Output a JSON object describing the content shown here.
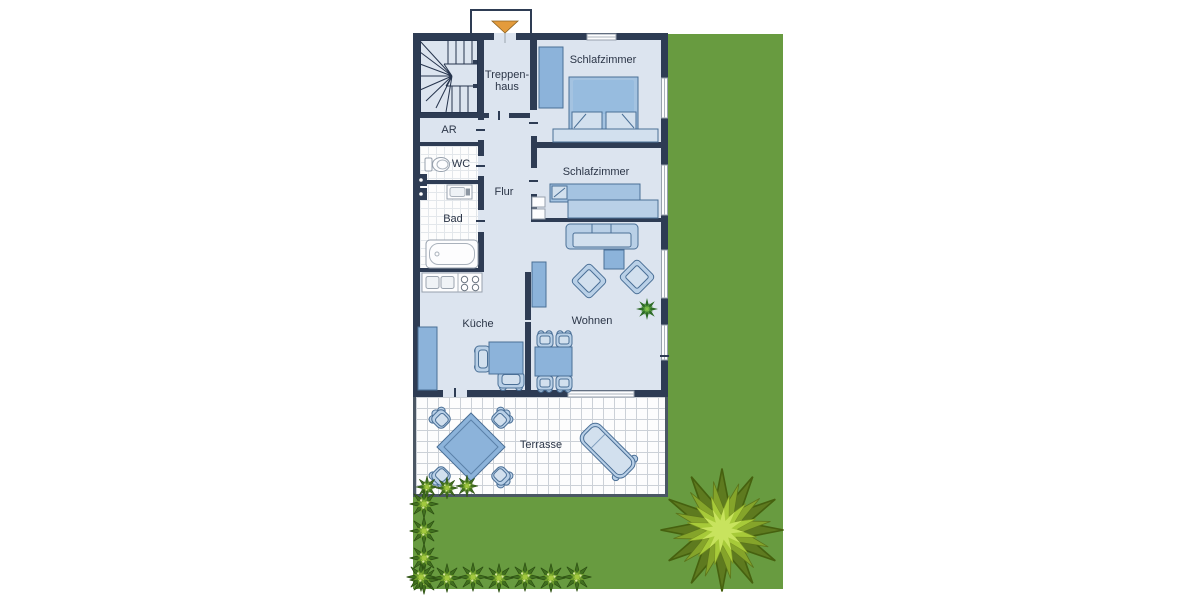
{
  "floorplan": {
    "labels": {
      "treppenhaus_line1": "Treppen-",
      "treppenhaus_line2": "haus",
      "schlafzimmer_top": "Schlafzimmer",
      "schlafzimmer_mid": "Schlafzimmer",
      "abstellraum": "AR",
      "wc": "WC",
      "flur": "Flur",
      "bad": "Bad",
      "kueche": "Küche",
      "wohnen": "Wohnen",
      "terrasse": "Terrasse"
    },
    "colors": {
      "wall": "#2e3c54",
      "floor": "#dce4ef",
      "lawn": "#689b40",
      "terrace_border": "#4b5764",
      "tile_grid": "#ccd1d7",
      "bath_tile_grid": "#e3e7eb",
      "furn_mid": "#8cb3da",
      "furn_bed": "#a4c3e1",
      "furn_light": "#b9d0e7",
      "furn_lighter": "#d2e0ee",
      "furn_stroke": "#4a6f96",
      "label": "#2b3547",
      "arrow": "#e39b3c",
      "green_dark": "#41701f",
      "green_mid": "#6f9e2c",
      "green_light": "#a3c93f"
    }
  }
}
